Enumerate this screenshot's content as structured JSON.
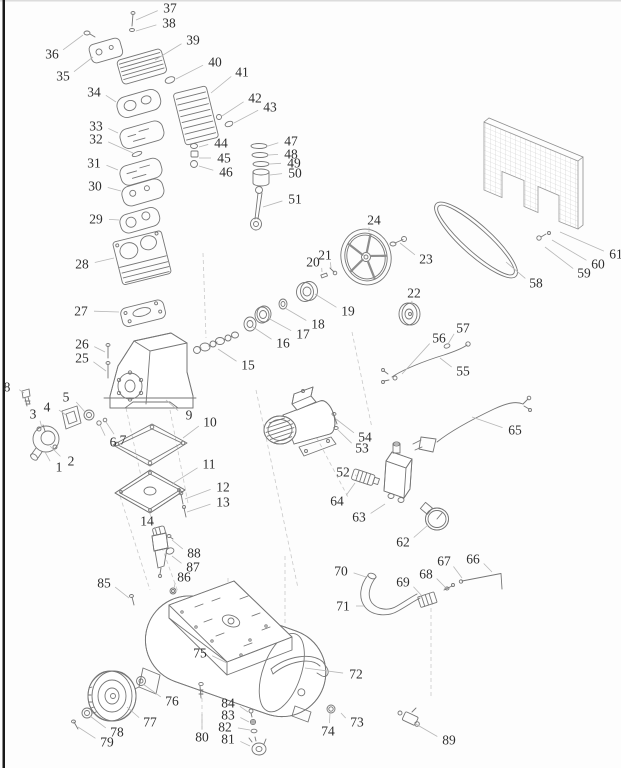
{
  "page": {
    "kind": "exploded-parts-diagram",
    "subject": "air-compressor",
    "part_count": 89,
    "colors": {
      "background": "#fdfdfd",
      "left_border": "#191919",
      "line": "#767676",
      "leader": "#b7b7b7",
      "label": "#2f2f2f",
      "mesh": "#c4c4c4"
    }
  },
  "diagram": {
    "labels": [
      {
        "n": "1",
        "x": 59,
        "y": 467,
        "tx": 45,
        "ty": 452
      },
      {
        "n": "2",
        "x": 71,
        "y": 461,
        "tx": 50,
        "ty": 446
      },
      {
        "n": "3",
        "x": 33,
        "y": 414,
        "tx": 42,
        "ty": 428
      },
      {
        "n": "4",
        "x": 47,
        "y": 407,
        "tx": 66,
        "ty": 415
      },
      {
        "n": "5",
        "x": 66,
        "y": 397,
        "tx": 85,
        "ty": 412
      },
      {
        "n": "6",
        "x": 113,
        "y": 442,
        "tx": 100,
        "ty": 425
      },
      {
        "n": "7",
        "x": 123,
        "y": 440,
        "tx": 106,
        "ty": 422
      },
      {
        "n": "8",
        "x": 7,
        "y": 387,
        "tx": 24,
        "ty": 393
      },
      {
        "n": "9",
        "x": 189,
        "y": 415,
        "tx": 166,
        "ty": 400
      },
      {
        "n": "10",
        "x": 210,
        "y": 422,
        "tx": 183,
        "ty": 438
      },
      {
        "n": "11",
        "x": 209,
        "y": 464,
        "tx": 172,
        "ty": 484
      },
      {
        "n": "12",
        "x": 223,
        "y": 487,
        "tx": 185,
        "ty": 499
      },
      {
        "n": "13",
        "x": 223,
        "y": 502,
        "tx": 187,
        "ty": 512
      },
      {
        "n": "14",
        "x": 147,
        "y": 521,
        "tx": 155,
        "ty": 530
      },
      {
        "n": "15",
        "x": 248,
        "y": 365,
        "tx": 218,
        "ty": 349
      },
      {
        "n": "16",
        "x": 283,
        "y": 343,
        "tx": 253,
        "ty": 327
      },
      {
        "n": "17",
        "x": 303,
        "y": 334,
        "tx": 268,
        "ty": 318
      },
      {
        "n": "18",
        "x": 318,
        "y": 324,
        "tx": 285,
        "ty": 308
      },
      {
        "n": "19",
        "x": 348,
        "y": 311,
        "tx": 315,
        "ty": 294
      },
      {
        "n": "20",
        "x": 313,
        "y": 262,
        "tx": 322,
        "ty": 272
      },
      {
        "n": "21",
        "x": 325,
        "y": 255,
        "tx": 331,
        "ty": 268
      },
      {
        "n": "22",
        "x": 414,
        "y": 293,
        "tx": 412,
        "ty": 305
      },
      {
        "n": "23",
        "x": 426,
        "y": 259,
        "tx": 400,
        "ty": 243
      },
      {
        "n": "24",
        "x": 374,
        "y": 220,
        "tx": 369,
        "ty": 232
      },
      {
        "n": "25",
        "x": 82,
        "y": 358,
        "tx": 106,
        "ty": 371
      },
      {
        "n": "26",
        "x": 82,
        "y": 344,
        "tx": 105,
        "ty": 352
      },
      {
        "n": "27",
        "x": 81,
        "y": 311,
        "tx": 119,
        "ty": 312
      },
      {
        "n": "28",
        "x": 82,
        "y": 264,
        "tx": 114,
        "ty": 258
      },
      {
        "n": "29",
        "x": 96,
        "y": 219,
        "tx": 119,
        "ty": 220
      },
      {
        "n": "30",
        "x": 95,
        "y": 186,
        "tx": 121,
        "ty": 191
      },
      {
        "n": "31",
        "x": 94,
        "y": 163,
        "tx": 118,
        "ty": 170
      },
      {
        "n": "32",
        "x": 96,
        "y": 139,
        "tx": 133,
        "ty": 153
      },
      {
        "n": "33",
        "x": 96,
        "y": 126,
        "tx": 118,
        "ty": 133
      },
      {
        "n": "34",
        "x": 94,
        "y": 92,
        "tx": 116,
        "ty": 102
      },
      {
        "n": "35",
        "x": 63,
        "y": 76,
        "tx": 93,
        "ty": 57
      },
      {
        "n": "36",
        "x": 52,
        "y": 54,
        "tx": 83,
        "ty": 35
      },
      {
        "n": "37",
        "x": 170,
        "y": 8,
        "tx": 136,
        "ty": 20
      },
      {
        "n": "38",
        "x": 169,
        "y": 23,
        "tx": 136,
        "ty": 31
      },
      {
        "n": "39",
        "x": 193,
        "y": 40,
        "tx": 155,
        "ty": 60
      },
      {
        "n": "40",
        "x": 215,
        "y": 62,
        "tx": 176,
        "ty": 79
      },
      {
        "n": "41",
        "x": 242,
        "y": 72,
        "tx": 211,
        "ty": 93
      },
      {
        "n": "42",
        "x": 255,
        "y": 98,
        "tx": 222,
        "ty": 116
      },
      {
        "n": "43",
        "x": 270,
        "y": 107,
        "tx": 234,
        "ty": 123
      },
      {
        "n": "44",
        "x": 221,
        "y": 143,
        "tx": 199,
        "ty": 147
      },
      {
        "n": "45",
        "x": 224,
        "y": 158,
        "tx": 199,
        "ty": 158
      },
      {
        "n": "46",
        "x": 226,
        "y": 172,
        "tx": 199,
        "ty": 166
      },
      {
        "n": "47",
        "x": 291,
        "y": 141,
        "tx": 268,
        "ty": 146
      },
      {
        "n": "48",
        "x": 291,
        "y": 154,
        "tx": 269,
        "ty": 155
      },
      {
        "n": "49",
        "x": 294,
        "y": 163,
        "tx": 270,
        "ty": 164
      },
      {
        "n": "50",
        "x": 295,
        "y": 173,
        "tx": 270,
        "ty": 175
      },
      {
        "n": "51",
        "x": 295,
        "y": 199,
        "tx": 263,
        "ty": 207
      },
      {
        "n": "52",
        "x": 343,
        "y": 472,
        "tx": 357,
        "ty": 477
      },
      {
        "n": "53",
        "x": 362,
        "y": 448,
        "tx": 337,
        "ty": 429
      },
      {
        "n": "54",
        "x": 365,
        "y": 437,
        "tx": 336,
        "ty": 419
      },
      {
        "n": "55",
        "x": 463,
        "y": 371,
        "tx": 440,
        "ty": 358
      },
      {
        "n": "56",
        "x": 439,
        "y": 338,
        "tx": 402,
        "ty": 374
      },
      {
        "n": "57",
        "x": 463,
        "y": 328,
        "tx": 448,
        "ty": 344
      },
      {
        "n": "58",
        "x": 536,
        "y": 283,
        "tx": 506,
        "ty": 262
      },
      {
        "n": "59",
        "x": 584,
        "y": 273,
        "tx": 545,
        "ty": 247
      },
      {
        "n": "60",
        "x": 598,
        "y": 264,
        "tx": 552,
        "ty": 240
      },
      {
        "n": "61",
        "x": 616,
        "y": 254,
        "tx": 560,
        "ty": 232
      },
      {
        "n": "62",
        "x": 403,
        "y": 542,
        "tx": 428,
        "ty": 525
      },
      {
        "n": "63",
        "x": 359,
        "y": 517,
        "tx": 385,
        "ty": 504
      },
      {
        "n": "64",
        "x": 337,
        "y": 501,
        "tx": 355,
        "ty": 483
      },
      {
        "n": "65",
        "x": 515,
        "y": 430,
        "tx": 472,
        "ty": 417
      },
      {
        "n": "66",
        "x": 473,
        "y": 559,
        "tx": 492,
        "ty": 572
      },
      {
        "n": "67",
        "x": 444,
        "y": 561,
        "tx": 462,
        "ty": 578
      },
      {
        "n": "68",
        "x": 426,
        "y": 574,
        "tx": 446,
        "ty": 588
      },
      {
        "n": "69",
        "x": 403,
        "y": 582,
        "tx": 422,
        "ty": 596
      },
      {
        "n": "70",
        "x": 341,
        "y": 571,
        "tx": 366,
        "ty": 577
      },
      {
        "n": "71",
        "x": 343,
        "y": 606,
        "tx": 364,
        "ty": 606
      },
      {
        "n": "72",
        "x": 356,
        "y": 674,
        "tx": 305,
        "ty": 668
      },
      {
        "n": "73",
        "x": 357,
        "y": 722,
        "tx": 341,
        "ty": 713
      },
      {
        "n": "74",
        "x": 328,
        "y": 731,
        "tx": 330,
        "ty": 713
      },
      {
        "n": "75",
        "x": 200,
        "y": 653,
        "tx": 227,
        "ty": 663
      },
      {
        "n": "76",
        "x": 172,
        "y": 701,
        "tx": 143,
        "ty": 684
      },
      {
        "n": "77",
        "x": 150,
        "y": 722,
        "tx": 127,
        "ty": 707
      },
      {
        "n": "78",
        "x": 117,
        "y": 732,
        "tx": 90,
        "ty": 716
      },
      {
        "n": "79",
        "x": 107,
        "y": 742,
        "tx": 78,
        "ty": 727
      },
      {
        "n": "80",
        "x": 202,
        "y": 737,
        "tx": 202,
        "ty": 714
      },
      {
        "n": "81",
        "x": 228,
        "y": 739,
        "tx": 250,
        "ty": 746
      },
      {
        "n": "82",
        "x": 225,
        "y": 727,
        "tx": 250,
        "ty": 730
      },
      {
        "n": "83",
        "x": 228,
        "y": 715,
        "tx": 249,
        "ty": 722
      },
      {
        "n": "84",
        "x": 228,
        "y": 703,
        "tx": 248,
        "ty": 712
      },
      {
        "n": "85",
        "x": 104,
        "y": 583,
        "tx": 129,
        "ty": 598
      },
      {
        "n": "86",
        "x": 184,
        "y": 577,
        "tx": 174,
        "ty": 588
      },
      {
        "n": "87",
        "x": 193,
        "y": 567,
        "tx": 172,
        "ty": 556
      },
      {
        "n": "88",
        "x": 194,
        "y": 553,
        "tx": 172,
        "ty": 540
      },
      {
        "n": "89",
        "x": 449,
        "y": 740,
        "tx": 414,
        "ty": 723
      }
    ]
  }
}
